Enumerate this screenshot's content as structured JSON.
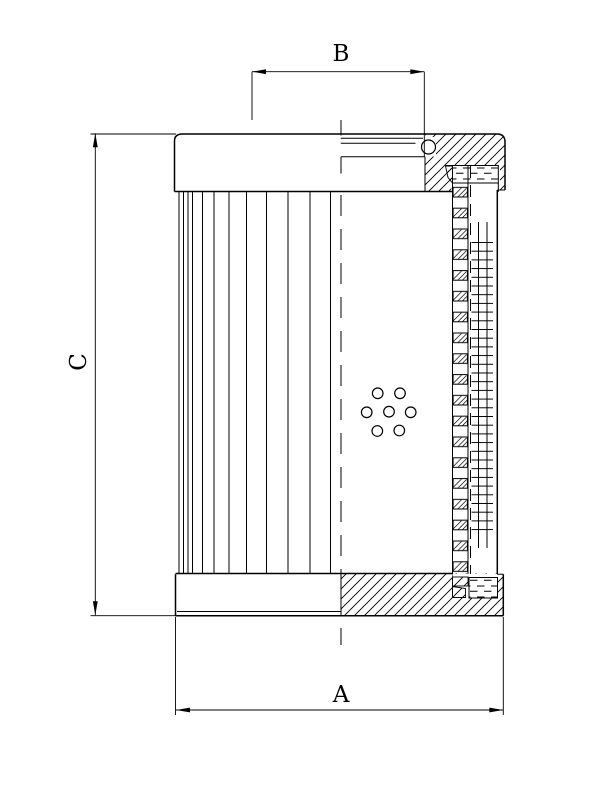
{
  "drawing": {
    "kind": "filter-element-cross-section",
    "labels": {
      "dim_outer_diameter": "A",
      "dim_collar_diameter": "B",
      "dim_height": "C"
    },
    "colors": {
      "ink": "#000000",
      "paper": "#ffffff"
    }
  }
}
